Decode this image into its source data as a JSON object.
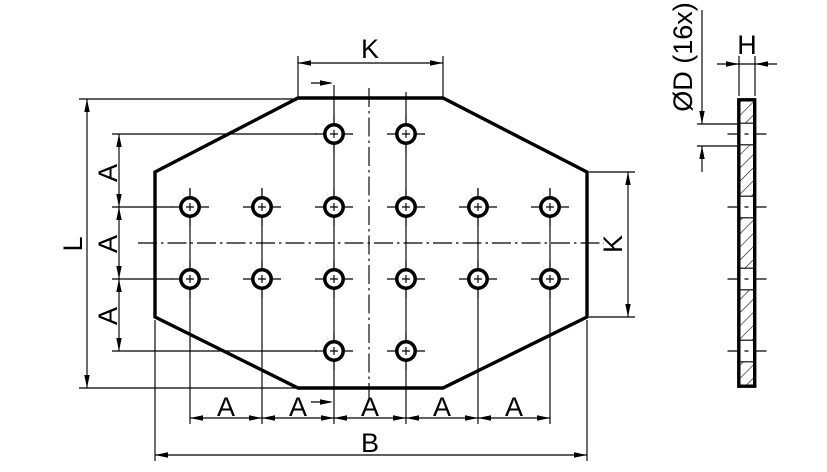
{
  "drawing": {
    "background_color": "#ffffff",
    "line_color": "#000000",
    "front_view": {
      "hole_total": 16,
      "hole_radius": 9.2,
      "hole_rows_y": [
        134,
        207,
        279,
        351
      ],
      "hole_layout": [
        [
          334,
          406
        ],
        [
          190,
          262,
          334,
          406,
          478,
          550
        ],
        [
          190,
          262,
          334,
          406,
          478,
          550
        ],
        [
          334,
          406
        ]
      ]
    },
    "side_view": {
      "gap_rows_y": [
        134,
        207,
        279,
        351
      ]
    },
    "dimensions": {
      "K_top": "K",
      "K_right": "K",
      "L": "L",
      "B": "B",
      "H": "H",
      "D": "ØD (16x)",
      "A_left": [
        "A",
        "A",
        "A"
      ],
      "A_bottom": [
        "A",
        "A",
        "A",
        "A",
        "A"
      ]
    }
  }
}
